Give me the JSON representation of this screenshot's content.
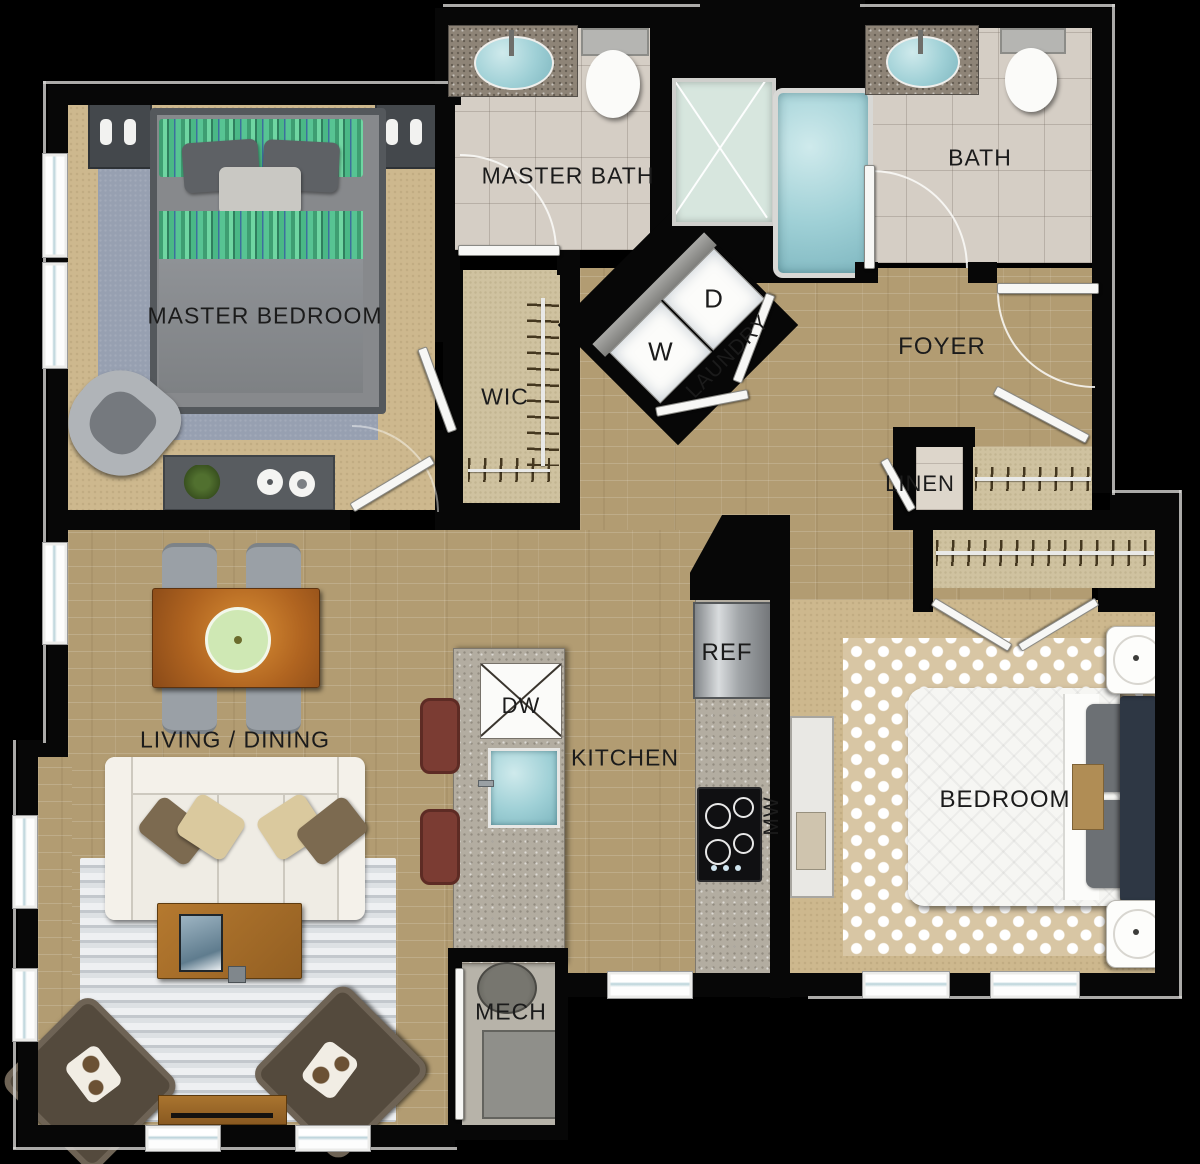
{
  "title": "Two Bedroom Apartment Floor Plan",
  "rooms": {
    "master_bedroom": {
      "label": "MASTER BEDROOM"
    },
    "master_bath": {
      "label": "MASTER BATH"
    },
    "bath": {
      "label": "BATH"
    },
    "wic": {
      "label": "WIC"
    },
    "laundry": {
      "label": "LAUNDRY",
      "washer": "W",
      "dryer": "D"
    },
    "foyer": {
      "label": "FOYER"
    },
    "linen": {
      "label": "LINEN"
    },
    "living_dining": {
      "label": "LIVING / DINING"
    },
    "kitchen": {
      "label": "KITCHEN",
      "dishwasher": "DW",
      "refrigerator": "REF",
      "microwave": "MW"
    },
    "bedroom": {
      "label": "BEDROOM"
    },
    "mech": {
      "label": "MECH"
    }
  },
  "colors": {
    "background": "#000000",
    "wall": "#070707",
    "wood_floor": "#b29c72",
    "carpet": "#cdb88e",
    "tile": "#d5cec5",
    "master_rug_blue": "#97a0b1",
    "water": "#9fd0d6",
    "granite": "#b3ada1",
    "label_text": "#1b1b1b",
    "stool_red": "#7b3c33",
    "bed_green": "#57c493"
  }
}
